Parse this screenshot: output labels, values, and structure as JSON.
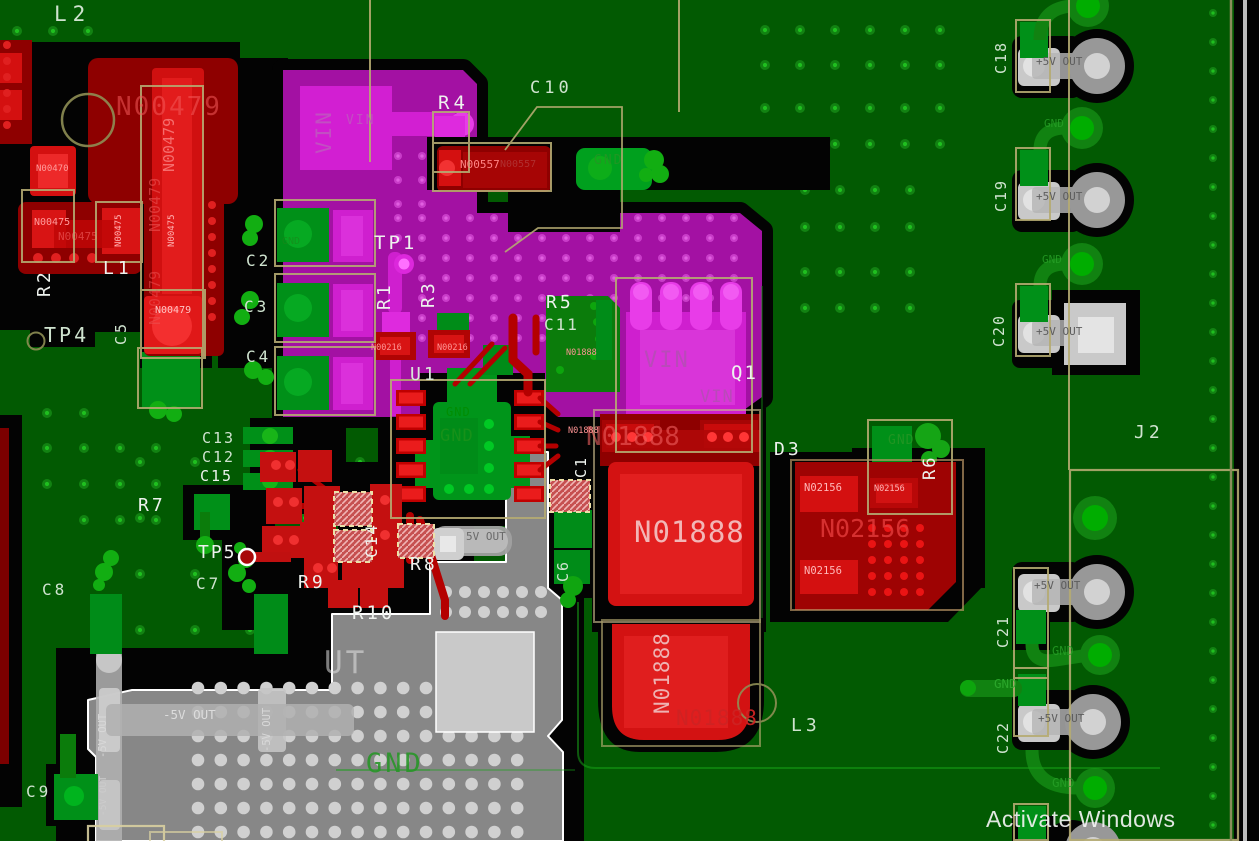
{
  "view": "pcb-layout-canvas",
  "colors": {
    "board_green": "#025a02",
    "copper_red": "#d41010",
    "dark_red": "#8e0000",
    "magenta_pour": "#a311a3",
    "bright_magenta": "#d21fd2",
    "copper_green": "#009018",
    "pour_gray": "#878787",
    "outline_tan": "#b5ab72",
    "silk_white": "#eef2ee",
    "silk_pale_green": "#cfe3cf",
    "gnd_green": "#2f9b2f",
    "black": "#030303"
  },
  "watermark": {
    "text": "Activate Windows"
  },
  "labels": [
    {
      "id": "ref-l2",
      "text": "L2",
      "x": 54,
      "y": 4,
      "s": 21,
      "c": "#cfe3cf",
      "ls": 6
    },
    {
      "id": "net-n00479-big",
      "text": "N00479",
      "x": 116,
      "y": 94,
      "s": 26,
      "c": "rgba(242,90,90,0.55)",
      "ls": 2
    },
    {
      "id": "net-n00479-v1",
      "text": "N00479",
      "x": 162,
      "y": 172,
      "s": 15,
      "c": "rgba(250,130,130,0.8)",
      "r": -90
    },
    {
      "id": "net-n00479-v2",
      "text": "N00479",
      "x": 148,
      "y": 232,
      "s": 15,
      "c": "rgba(235,85,85,0.6)",
      "r": -90
    },
    {
      "id": "net-n00479-v3",
      "text": "N00479",
      "x": 148,
      "y": 325,
      "s": 15,
      "c": "rgba(235,85,85,0.5)",
      "r": -90
    },
    {
      "id": "net-n00479-pad",
      "text": "N00479",
      "x": 155,
      "y": 306,
      "s": 10,
      "c": "#ffc4c4"
    },
    {
      "id": "net-n00470",
      "text": "N00470",
      "x": 36,
      "y": 165,
      "s": 9,
      "c": "#ff9c9c"
    },
    {
      "id": "net-n00475-a",
      "text": "N00475",
      "x": 34,
      "y": 218,
      "s": 10,
      "c": "#ff9c9c"
    },
    {
      "id": "net-n00475-b",
      "text": "N00475",
      "x": 58,
      "y": 231,
      "s": 11,
      "c": "rgba(255,120,120,0.5)"
    },
    {
      "id": "net-n00475-c",
      "text": "N00475",
      "x": 115,
      "y": 247,
      "s": 9,
      "c": "#ffb0b0",
      "r": -90
    },
    {
      "id": "net-n00475-d",
      "text": "N00475",
      "x": 168,
      "y": 247,
      "s": 9,
      "c": "#ffb0b0",
      "r": -90
    },
    {
      "id": "ref-r2",
      "text": "R2",
      "x": 36,
      "y": 297,
      "s": 18,
      "c": "#eef2ee",
      "r": -90,
      "ls": 3
    },
    {
      "id": "ref-l1",
      "text": "L1",
      "x": 103,
      "y": 260,
      "s": 18,
      "c": "#eef2ee",
      "ls": 4
    },
    {
      "id": "ref-c2",
      "text": "C2",
      "x": 246,
      "y": 253,
      "s": 16,
      "c": "#cfe3cf",
      "ls": 3
    },
    {
      "id": "ref-c3",
      "text": "C3",
      "x": 244,
      "y": 299,
      "s": 16,
      "c": "#cfe3cf",
      "ls": 3
    },
    {
      "id": "ref-c4",
      "text": "C4",
      "x": 246,
      "y": 349,
      "s": 16,
      "c": "#cfe3cf",
      "ls": 3
    },
    {
      "id": "ref-c5",
      "text": "C5",
      "x": 114,
      "y": 345,
      "s": 15,
      "c": "#cfe3cf",
      "r": -90,
      "ls": 3
    },
    {
      "id": "ref-tp4",
      "text": "TP4",
      "x": 44,
      "y": 325,
      "s": 20,
      "c": "#cfe3cf",
      "ls": 3
    },
    {
      "id": "ref-tp1",
      "text": "TP1",
      "x": 374,
      "y": 234,
      "s": 19,
      "c": "#eef2ee",
      "ls": 3
    },
    {
      "id": "ref-r1",
      "text": "R1",
      "x": 376,
      "y": 310,
      "s": 18,
      "c": "#eef2ee",
      "r": -90,
      "ls": 3
    },
    {
      "id": "ref-r3",
      "text": "R3",
      "x": 420,
      "y": 308,
      "s": 18,
      "c": "#eef2ee",
      "r": -90,
      "ls": 3
    },
    {
      "id": "ref-r4",
      "text": "R4",
      "x": 438,
      "y": 94,
      "s": 19,
      "c": "#eef2ee",
      "ls": 4
    },
    {
      "id": "ref-c10",
      "text": "C10",
      "x": 530,
      "y": 80,
      "s": 17,
      "c": "#cfe3cf",
      "ls": 4
    },
    {
      "id": "net-vin-v",
      "text": "VIN",
      "x": 314,
      "y": 154,
      "s": 21,
      "c": "#c24fc2",
      "r": -90,
      "ls": 2
    },
    {
      "id": "net-vin-sm",
      "text": "VIN",
      "x": 346,
      "y": 114,
      "s": 13,
      "c": "#c24fc2",
      "ls": 2
    },
    {
      "id": "ref-u1",
      "text": "U1",
      "x": 410,
      "y": 366,
      "s": 18,
      "c": "#d9e6d9",
      "ls": 3
    },
    {
      "id": "ref-r5",
      "text": "R5",
      "x": 546,
      "y": 294,
      "s": 18,
      "c": "#eef2ee",
      "ls": 3
    },
    {
      "id": "ref-c11",
      "text": "C11",
      "x": 544,
      "y": 317,
      "s": 16,
      "c": "#cfe3cf",
      "ls": 2
    },
    {
      "id": "net-gnd-c10",
      "text": "GND",
      "x": 594,
      "y": 154,
      "s": 13,
      "c": "rgba(35,150,35,0.9)",
      "ls": 2
    },
    {
      "id": "net-n00557-a",
      "text": "N00557",
      "x": 460,
      "y": 159,
      "s": 11,
      "c": "#ff8585"
    },
    {
      "id": "net-n00557-b",
      "text": "N00557",
      "x": 500,
      "y": 160,
      "s": 10,
      "c": "#b03030"
    },
    {
      "id": "net-n00216-a",
      "text": "N00216",
      "x": 371,
      "y": 344,
      "s": 8.5,
      "c": "#ff9595"
    },
    {
      "id": "net-n00216-b",
      "text": "N00216",
      "x": 437,
      "y": 344,
      "s": 8.5,
      "c": "#ff9595"
    },
    {
      "id": "net-gnd-u1a",
      "text": "GND",
      "x": 446,
      "y": 406,
      "s": 12,
      "c": "rgba(0,140,0,0.9)",
      "ls": 1
    },
    {
      "id": "net-gnd-u1b",
      "text": "GND",
      "x": 440,
      "y": 428,
      "s": 17,
      "c": "rgba(25,145,25,0.9)",
      "ls": 1
    },
    {
      "id": "ref-c13",
      "text": "C13",
      "x": 202,
      "y": 431,
      "s": 15,
      "c": "#cfe3cf",
      "ls": 2
    },
    {
      "id": "ref-c12",
      "text": "C12",
      "x": 202,
      "y": 450,
      "s": 15,
      "c": "#cfe3cf",
      "ls": 2
    },
    {
      "id": "ref-c15",
      "text": "C15",
      "x": 200,
      "y": 469,
      "s": 15,
      "c": "#eef2ee",
      "ls": 2
    },
    {
      "id": "ref-r7",
      "text": "R7",
      "x": 138,
      "y": 497,
      "s": 18,
      "c": "#eef2ee",
      "ls": 3
    },
    {
      "id": "ref-tp5",
      "text": "TP5",
      "x": 198,
      "y": 544,
      "s": 18,
      "c": "#eef2ee",
      "ls": 2
    },
    {
      "id": "ref-c7",
      "text": "C7",
      "x": 196,
      "y": 576,
      "s": 16,
      "c": "#cfe3cf",
      "ls": 3
    },
    {
      "id": "ref-c8",
      "text": "C8",
      "x": 42,
      "y": 582,
      "s": 16,
      "c": "#cfe3cf",
      "ls": 3
    },
    {
      "id": "ref-c9",
      "text": "C9",
      "x": 26,
      "y": 784,
      "s": 16,
      "c": "#cfe3cf",
      "ls": 3
    },
    {
      "id": "ref-r9",
      "text": "R9",
      "x": 298,
      "y": 574,
      "s": 18,
      "c": "#eef2ee",
      "ls": 3
    },
    {
      "id": "ref-c14",
      "text": "C14",
      "x": 364,
      "y": 558,
      "s": 16,
      "c": "#eef2ee",
      "r": -90,
      "ls": 2
    },
    {
      "id": "ref-r8",
      "text": "R8",
      "x": 410,
      "y": 556,
      "s": 18,
      "c": "#eef2ee",
      "ls": 3
    },
    {
      "id": "ref-r10",
      "text": "R10",
      "x": 352,
      "y": 604,
      "s": 19,
      "c": "#eef2ee",
      "ls": 3
    },
    {
      "id": "ref-c1",
      "text": "C1",
      "x": 574,
      "y": 478,
      "s": 15,
      "c": "#eef2ee",
      "r": -90,
      "ls": 2
    },
    {
      "id": "ref-c6",
      "text": "C6",
      "x": 556,
      "y": 582,
      "s": 15,
      "c": "#cfe3cf",
      "r": -90,
      "ls": 2
    },
    {
      "id": "txt-5vout-sm",
      "text": "5V OUT",
      "x": 466,
      "y": 531,
      "s": 11,
      "c": "#6a6a6a"
    },
    {
      "id": "txt-m5vout-h",
      "text": "-5V OUT",
      "x": 163,
      "y": 709,
      "s": 12.5,
      "c": "#dcdcdc"
    },
    {
      "id": "txt-m5vout-v1",
      "text": "-5V OUT",
      "x": 98,
      "y": 758,
      "s": 10.5,
      "c": "#d8d8d8",
      "r": -90
    },
    {
      "id": "txt-m5vout-v2",
      "text": "-5V OUT",
      "x": 262,
      "y": 752,
      "s": 10.5,
      "c": "#d8d8d8",
      "r": -90
    },
    {
      "id": "txt-m5vout-v3",
      "text": "-5V OUT",
      "x": 99,
      "y": 816,
      "s": 9.5,
      "c": "#cccccc",
      "r": -90
    },
    {
      "id": "txt-ut-big",
      "text": "UT",
      "x": 324,
      "y": 648,
      "s": 31,
      "c": "rgba(225,225,225,0.55)",
      "ls": 3
    },
    {
      "id": "txt-gnd-big",
      "text": "GND",
      "x": 366,
      "y": 750,
      "s": 27,
      "c": "rgba(40,150,40,0.9)",
      "ls": 3
    },
    {
      "id": "net-n01888-top",
      "text": "N01888",
      "x": 586,
      "y": 424,
      "s": 26,
      "c": "rgba(238,95,95,0.6)"
    },
    {
      "id": "net-n01888-big",
      "text": "N01888",
      "x": 634,
      "y": 518,
      "s": 29,
      "c": "#f2b6b6",
      "ls": 1
    },
    {
      "id": "net-n01888-s1",
      "text": "N01888",
      "x": 566,
      "y": 349,
      "s": 8.5,
      "c": "#ff9595"
    },
    {
      "id": "net-n01888-s2",
      "text": "N01888",
      "x": 568,
      "y": 427,
      "s": 8.5,
      "c": "#ff9595"
    },
    {
      "id": "net-n01888-v",
      "text": "N01888",
      "x": 652,
      "y": 714,
      "s": 21,
      "c": "#eeb2b2",
      "r": -90,
      "ls": 1
    },
    {
      "id": "net-n01888-r",
      "text": "N01888",
      "x": 676,
      "y": 708,
      "s": 21,
      "c": "rgba(205,35,35,0.95)",
      "ls": 1
    },
    {
      "id": "net-vin-q1",
      "text": "VIN",
      "x": 644,
      "y": 350,
      "s": 22,
      "c": "#b94ab9",
      "ls": 2
    },
    {
      "id": "net-vin-q1b",
      "text": "VIN",
      "x": 700,
      "y": 389,
      "s": 17,
      "c": "#b94ab9",
      "ls": 1
    },
    {
      "id": "ref-q1",
      "text": "Q1",
      "x": 731,
      "y": 364,
      "s": 19,
      "c": "#eef2ee",
      "ls": 2
    },
    {
      "id": "ref-d3",
      "text": "D3",
      "x": 774,
      "y": 441,
      "s": 18,
      "c": "#eef2ee",
      "ls": 3
    },
    {
      "id": "net-n02156-a",
      "text": "N02156",
      "x": 804,
      "y": 483,
      "s": 10.5,
      "c": "#ffb8b8"
    },
    {
      "id": "net-n02156-b",
      "text": "N02156",
      "x": 804,
      "y": 566,
      "s": 10.5,
      "c": "#ffb8b8"
    },
    {
      "id": "net-n02156-c",
      "text": "N02156",
      "x": 874,
      "y": 485,
      "s": 8.5,
      "c": "#ffb8b8"
    },
    {
      "id": "net-n02156-big",
      "text": "N02156",
      "x": 820,
      "y": 516,
      "s": 25,
      "c": "rgba(228,60,60,0.8)"
    },
    {
      "id": "net-gnd-r6",
      "text": "GND",
      "x": 888,
      "y": 434,
      "s": 13,
      "c": "rgba(35,150,35,0.9)",
      "ls": 1
    },
    {
      "id": "ref-r6",
      "text": "R6",
      "x": 922,
      "y": 480,
      "s": 17,
      "c": "#eef2ee",
      "r": -90,
      "ls": 2
    },
    {
      "id": "ref-l3",
      "text": "L3",
      "x": 791,
      "y": 717,
      "s": 18,
      "c": "#cfe3cf",
      "ls": 4
    },
    {
      "id": "ref-j2",
      "text": "J2",
      "x": 1134,
      "y": 424,
      "s": 18,
      "c": "#cfe3cf",
      "ls": 4
    },
    {
      "id": "ref-c18",
      "text": "C18",
      "x": 994,
      "y": 74,
      "s": 15,
      "c": "#cfe3cf",
      "r": -90,
      "ls": 2
    },
    {
      "id": "ref-c19",
      "text": "C19",
      "x": 994,
      "y": 212,
      "s": 15,
      "c": "#cfe3cf",
      "r": -90,
      "ls": 2
    },
    {
      "id": "ref-c20",
      "text": "C20",
      "x": 992,
      "y": 347,
      "s": 15,
      "c": "#cfe3cf",
      "r": -90,
      "ls": 2
    },
    {
      "id": "ref-c21",
      "text": "C21",
      "x": 996,
      "y": 648,
      "s": 15,
      "c": "#cfe3cf",
      "r": -90,
      "ls": 2
    },
    {
      "id": "ref-c22",
      "text": "C22",
      "x": 996,
      "y": 754,
      "s": 15,
      "c": "#cfe3cf",
      "r": -90,
      "ls": 2
    },
    {
      "id": "txt-p5v-1",
      "text": "+5V OUT",
      "x": 1036,
      "y": 56,
      "s": 11,
      "c": "#5d5d5d"
    },
    {
      "id": "txt-p5v-2",
      "text": "+5V OUT",
      "x": 1036,
      "y": 191,
      "s": 11,
      "c": "#5d5d5d"
    },
    {
      "id": "txt-p5v-3",
      "text": "+5V OUT",
      "x": 1036,
      "y": 326,
      "s": 11,
      "c": "#5d5d5d"
    },
    {
      "id": "txt-p5v-4",
      "text": "+5V OUT",
      "x": 1034,
      "y": 580,
      "s": 11,
      "c": "#5d5d5d"
    },
    {
      "id": "txt-p5v-5",
      "text": "+5V OUT",
      "x": 1038,
      "y": 713,
      "s": 11,
      "c": "#5d5d5d"
    },
    {
      "id": "net-gnd-r1",
      "text": "GND",
      "x": 1044,
      "y": 118,
      "s": 11,
      "c": "rgba(40,160,40,0.8)"
    },
    {
      "id": "net-gnd-r2",
      "text": "GND",
      "x": 1042,
      "y": 254,
      "s": 11,
      "c": "rgba(40,160,40,0.8)"
    },
    {
      "id": "net-gnd-r3",
      "text": "GND",
      "x": 1052,
      "y": 645,
      "s": 12,
      "c": "rgba(40,160,40,0.8)"
    },
    {
      "id": "net-gnd-r4",
      "text": "GND",
      "x": 994,
      "y": 678,
      "s": 12.5,
      "c": "rgba(45,170,45,0.9)"
    },
    {
      "id": "net-gnd-r5",
      "text": "GND",
      "x": 1052,
      "y": 777,
      "s": 12.5,
      "c": "rgba(40,160,40,0.8)"
    },
    {
      "id": "net-gnd-c2pad",
      "text": "GND",
      "x": 282,
      "y": 237,
      "s": 10,
      "c": "rgba(25,135,25,0.7)"
    },
    {
      "id": "watermark",
      "text": "Activate Windows",
      "x": 986,
      "y": 808,
      "s": 23,
      "c": "rgba(243,243,243,0.92)",
      "f": "sans",
      "ls": 0.5
    }
  ]
}
